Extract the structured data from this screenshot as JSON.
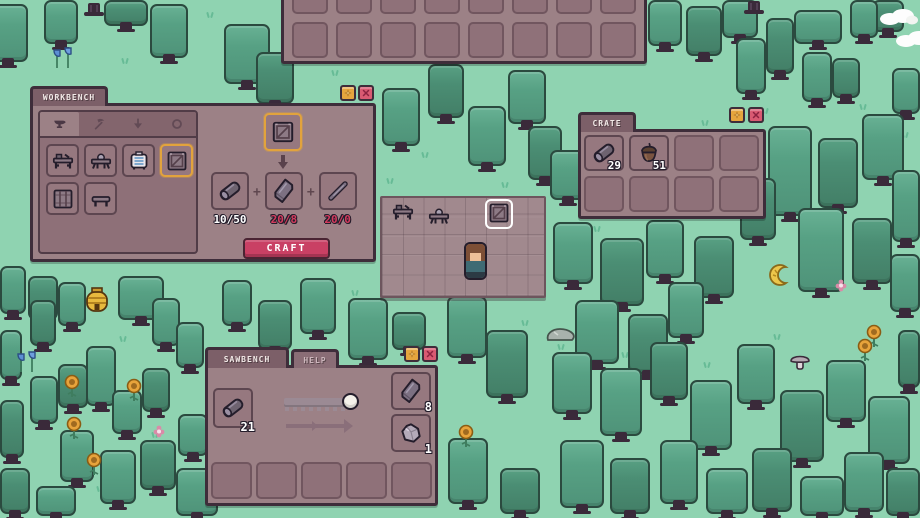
{
  "window": {
    "width": 920,
    "height": 518
  },
  "colors": {
    "grass": "#8fd3b1",
    "tree": "#57a184",
    "tree_dark": "#4b8e74",
    "panel": "#9c8186",
    "panel_border": "#3e2d3a",
    "slot_border": "#5d4650",
    "accent_orange": "#e2a33c",
    "craft_button": "#c94064",
    "insufficient_red": "#d33b5e",
    "floor": "#a1898e"
  },
  "top_inventory": {
    "cols": 8,
    "rows": 2
  },
  "workbench": {
    "title": "WORKBENCH",
    "settings_icon": "sparkle-icon",
    "close_icon": "close-x-icon",
    "plus_sign": "+",
    "tabs": [
      {
        "icon": "anvil-icon",
        "selected": true
      },
      {
        "icon": "pickaxe-icon",
        "selected": false
      },
      {
        "icon": "arrow-down-icon",
        "selected": false
      },
      {
        "icon": "ring-icon",
        "selected": false
      }
    ],
    "items": [
      {
        "icon": "workbench-icon",
        "selected": false
      },
      {
        "icon": "sawbench-icon",
        "selected": false
      },
      {
        "icon": "furnace-icon",
        "selected": false
      },
      {
        "icon": "crate-icon",
        "selected": true
      },
      {
        "icon": "crate2-icon",
        "selected": false
      },
      {
        "icon": "bench-icon",
        "selected": false
      }
    ],
    "selected_item_icon": "crate-icon",
    "recipe": [
      {
        "icon": "log-icon",
        "label": "10/50",
        "enough": true
      },
      {
        "icon": "plank-icon",
        "label": "20/8",
        "enough": false
      },
      {
        "icon": "stick-icon",
        "label": "20/0",
        "enough": false
      }
    ],
    "craft_label": "CRAFT"
  },
  "crate": {
    "title": "CRATE",
    "settings_icon": "sparkle-icon",
    "close_icon": "close-x-icon",
    "slots": [
      {
        "icon": "log-icon",
        "count": "29"
      },
      {
        "icon": "acorn-icon",
        "count": "51"
      },
      {},
      {},
      {},
      {},
      {},
      {}
    ]
  },
  "sawbench": {
    "title": "SAWBENCH",
    "help_label": "HELP",
    "settings_icon": "sparkle-icon",
    "close_icon": "close-x-icon",
    "input": {
      "icon": "log-icon",
      "count": "21"
    },
    "outputs": [
      {
        "icon": "plank-icon",
        "count": "8"
      },
      {
        "icon": "chunk-icon",
        "count": "1"
      }
    ],
    "bottom_slot_count": 5
  },
  "world": {
    "placed": [
      {
        "icon": "workbench-icon",
        "name": "placed-workbench"
      },
      {
        "icon": "sawbench-icon",
        "name": "placed-sawbench"
      },
      {
        "icon": "crate-icon",
        "name": "placed-crate",
        "highlighted": true
      }
    ]
  },
  "scenery": {
    "trees": [
      [
        -12,
        4,
        40,
        58,
        0
      ],
      [
        44,
        0,
        34,
        44,
        0
      ],
      [
        104,
        0,
        44,
        26,
        1
      ],
      [
        150,
        4,
        38,
        54,
        0
      ],
      [
        224,
        24,
        46,
        60,
        0
      ],
      [
        256,
        52,
        38,
        52,
        1
      ],
      [
        648,
        0,
        34,
        46,
        0
      ],
      [
        686,
        6,
        36,
        50,
        1
      ],
      [
        722,
        0,
        36,
        38,
        0
      ],
      [
        736,
        38,
        30,
        56,
        0
      ],
      [
        766,
        18,
        28,
        56,
        1
      ],
      [
        794,
        10,
        48,
        34,
        0
      ],
      [
        802,
        52,
        30,
        50,
        0
      ],
      [
        832,
        58,
        28,
        40,
        1
      ],
      [
        850,
        0,
        28,
        38,
        0
      ],
      [
        872,
        0,
        32,
        32,
        1
      ],
      [
        892,
        68,
        28,
        46,
        0
      ],
      [
        382,
        88,
        38,
        58,
        0
      ],
      [
        428,
        64,
        36,
        54,
        1
      ],
      [
        468,
        106,
        38,
        60,
        0
      ],
      [
        508,
        70,
        38,
        54,
        0
      ],
      [
        528,
        126,
        34,
        54,
        1
      ],
      [
        550,
        150,
        36,
        50,
        0
      ],
      [
        553,
        222,
        40,
        62,
        0
      ],
      [
        600,
        238,
        44,
        68,
        1
      ],
      [
        646,
        220,
        38,
        58,
        0
      ],
      [
        694,
        236,
        40,
        62,
        1
      ],
      [
        575,
        300,
        44,
        64,
        0
      ],
      [
        628,
        314,
        40,
        60,
        1
      ],
      [
        668,
        282,
        36,
        56,
        0
      ],
      [
        768,
        126,
        44,
        90,
        0
      ],
      [
        818,
        138,
        40,
        70,
        1
      ],
      [
        862,
        114,
        42,
        66,
        0
      ],
      [
        892,
        170,
        28,
        72,
        0
      ],
      [
        740,
        178,
        36,
        62,
        1
      ],
      [
        798,
        208,
        46,
        84,
        0
      ],
      [
        852,
        218,
        40,
        66,
        1
      ],
      [
        890,
        254,
        30,
        58,
        0
      ],
      [
        447,
        296,
        40,
        62,
        0
      ],
      [
        486,
        330,
        42,
        68,
        1
      ],
      [
        552,
        352,
        40,
        62,
        0
      ],
      [
        600,
        368,
        42,
        68,
        0
      ],
      [
        650,
        342,
        38,
        58,
        1
      ],
      [
        690,
        380,
        42,
        70,
        0
      ],
      [
        737,
        344,
        38,
        60,
        0
      ],
      [
        780,
        390,
        44,
        72,
        1
      ],
      [
        826,
        360,
        40,
        62,
        0
      ],
      [
        868,
        396,
        42,
        68,
        0
      ],
      [
        898,
        330,
        22,
        58,
        1
      ],
      [
        560,
        440,
        44,
        68,
        0
      ],
      [
        610,
        458,
        40,
        56,
        1
      ],
      [
        660,
        440,
        38,
        64,
        0
      ],
      [
        706,
        468,
        42,
        46,
        0
      ],
      [
        752,
        448,
        40,
        64,
        1
      ],
      [
        800,
        476,
        44,
        40,
        0
      ],
      [
        844,
        452,
        40,
        60,
        0
      ],
      [
        886,
        468,
        34,
        48,
        1
      ],
      [
        448,
        438,
        40,
        66,
        0
      ],
      [
        500,
        468,
        40,
        46,
        1
      ],
      [
        0,
        266,
        26,
        48,
        0
      ],
      [
        28,
        276,
        30,
        44,
        1
      ],
      [
        58,
        282,
        28,
        44,
        0
      ],
      [
        118,
        276,
        46,
        44,
        0
      ],
      [
        30,
        300,
        26,
        46,
        1
      ],
      [
        0,
        330,
        22,
        50,
        0
      ],
      [
        152,
        298,
        28,
        48,
        0
      ],
      [
        176,
        322,
        28,
        46,
        0
      ],
      [
        86,
        346,
        30,
        60,
        0
      ],
      [
        58,
        364,
        30,
        44,
        1
      ],
      [
        30,
        376,
        28,
        48,
        0
      ],
      [
        112,
        390,
        30,
        44,
        0
      ],
      [
        142,
        368,
        28,
        44,
        1
      ],
      [
        0,
        400,
        24,
        58,
        1
      ],
      [
        178,
        414,
        30,
        42,
        0
      ],
      [
        60,
        430,
        34,
        52,
        0
      ],
      [
        100,
        450,
        36,
        54,
        0
      ],
      [
        140,
        440,
        36,
        50,
        1
      ],
      [
        0,
        468,
        30,
        46,
        1
      ],
      [
        36,
        486,
        40,
        30,
        0
      ],
      [
        176,
        468,
        42,
        48,
        0
      ],
      [
        348,
        298,
        40,
        62,
        0
      ],
      [
        392,
        312,
        34,
        38,
        1
      ],
      [
        300,
        278,
        36,
        56,
        0
      ],
      [
        258,
        300,
        34,
        50,
        1
      ],
      [
        222,
        280,
        30,
        46,
        0
      ]
    ],
    "props": [
      {
        "t": "beehive",
        "x": 84,
        "y": 286
      },
      {
        "t": "cloud",
        "x": 878,
        "y": 8
      },
      {
        "t": "cloud",
        "x": 894,
        "y": 30
      },
      {
        "t": "mushroom",
        "x": 788,
        "y": 350
      },
      {
        "t": "rock",
        "x": 544,
        "y": 326
      },
      {
        "t": "croissant",
        "x": 766,
        "y": 262
      },
      {
        "t": "flower-red",
        "x": 314,
        "y": 4
      },
      {
        "t": "stump",
        "x": 80,
        "y": 2
      },
      {
        "t": "stump",
        "x": 740,
        "y": 0
      },
      {
        "t": "sunflower",
        "x": 64,
        "y": 374
      },
      {
        "t": "sunflower",
        "x": 126,
        "y": 378
      },
      {
        "t": "sunflower",
        "x": 66,
        "y": 416
      },
      {
        "t": "sunflower",
        "x": 86,
        "y": 452
      },
      {
        "t": "sunflower",
        "x": 866,
        "y": 324
      },
      {
        "t": "sunflower",
        "x": 857,
        "y": 338
      },
      {
        "t": "sunflower",
        "x": 458,
        "y": 424
      },
      {
        "t": "flower-blue",
        "x": 50,
        "y": 44
      },
      {
        "t": "flower-blue",
        "x": 14,
        "y": 348
      },
      {
        "t": "flower-pink",
        "x": 152,
        "y": 424
      },
      {
        "t": "flower-pink",
        "x": 834,
        "y": 278
      }
    ],
    "tufts": [
      [
        205,
        12
      ],
      [
        120,
        58
      ],
      [
        40,
        92
      ],
      [
        330,
        70
      ],
      [
        385,
        178
      ],
      [
        420,
        152
      ],
      [
        500,
        182
      ],
      [
        560,
        200
      ],
      [
        592,
        226
      ],
      [
        700,
        120
      ],
      [
        760,
        108
      ],
      [
        858,
        104
      ],
      [
        900,
        132
      ],
      [
        556,
        344
      ],
      [
        620,
        352
      ],
      [
        702,
        362
      ],
      [
        772,
        334
      ],
      [
        850,
        386
      ],
      [
        896,
        420
      ],
      [
        470,
        310
      ],
      [
        520,
        320
      ],
      [
        562,
        470
      ],
      [
        640,
        504
      ],
      [
        118,
        336
      ],
      [
        34,
        344
      ],
      [
        150,
        432
      ],
      [
        95,
        486
      ],
      [
        300,
        320
      ],
      [
        350,
        290
      ]
    ]
  }
}
